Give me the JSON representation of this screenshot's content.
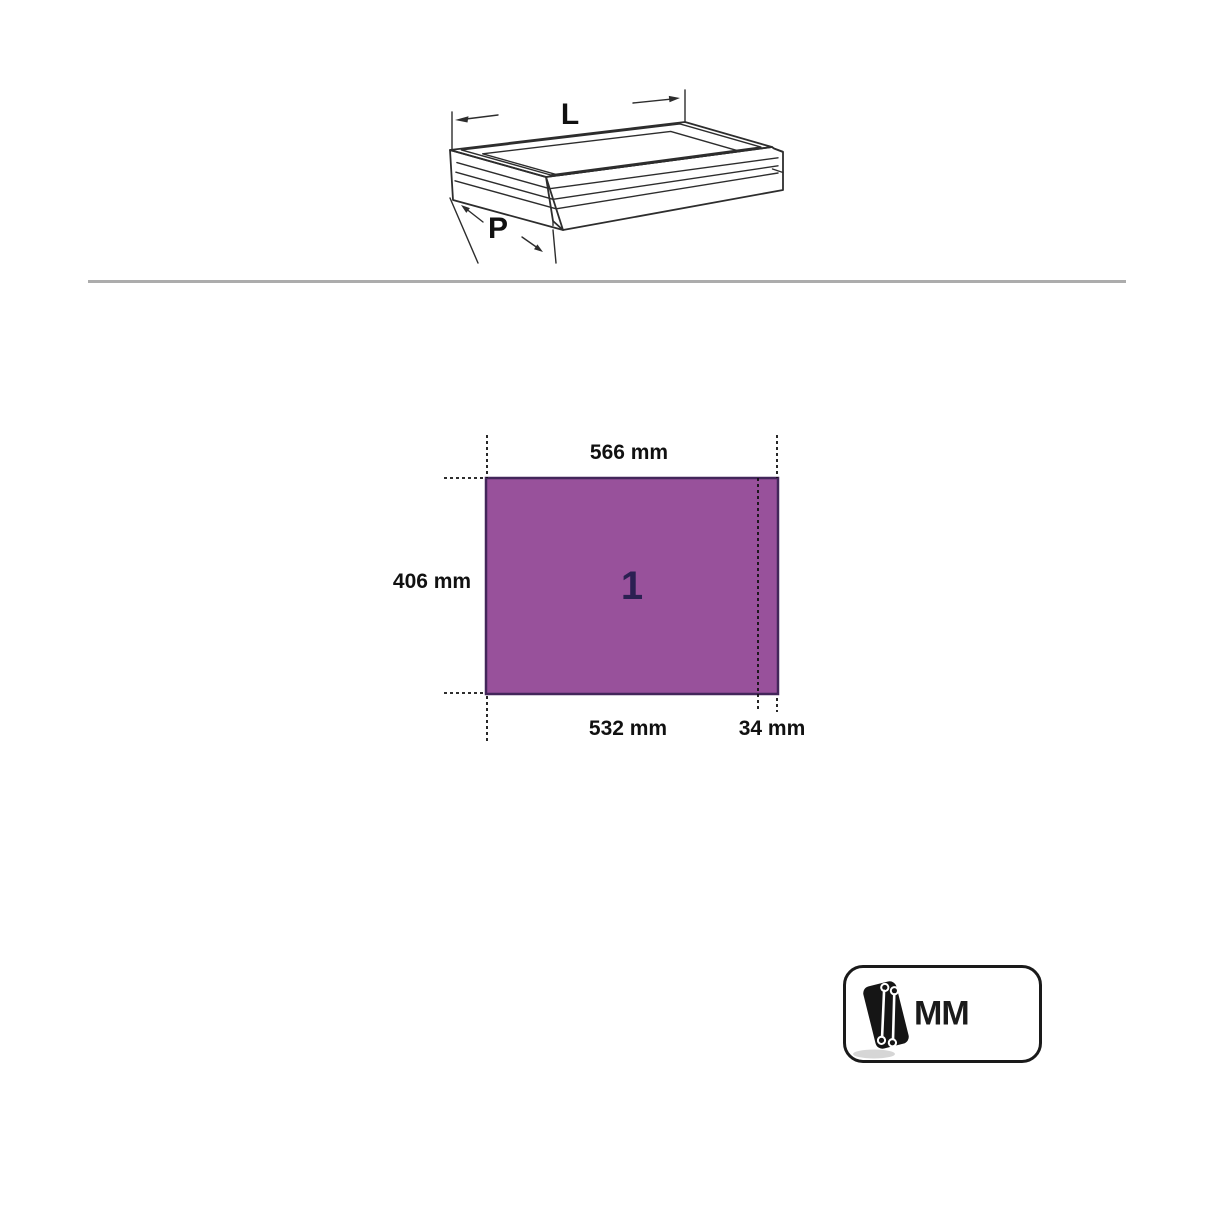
{
  "figure": {
    "length_label": "L",
    "depth_label": "P"
  },
  "panel": {
    "number": "1",
    "width_top": "566 mm",
    "height_left": "406 mm",
    "width_bottom": "532 mm",
    "width_bottom_right": "34 mm",
    "fill_color": "#98519b",
    "border_color": "#43265a"
  },
  "unit_badge": {
    "label": "MM",
    "icon": "wrench-tray-icon"
  },
  "colors": {
    "divider": "#acacac",
    "line": "#2d2d2d",
    "text": "#111111"
  }
}
